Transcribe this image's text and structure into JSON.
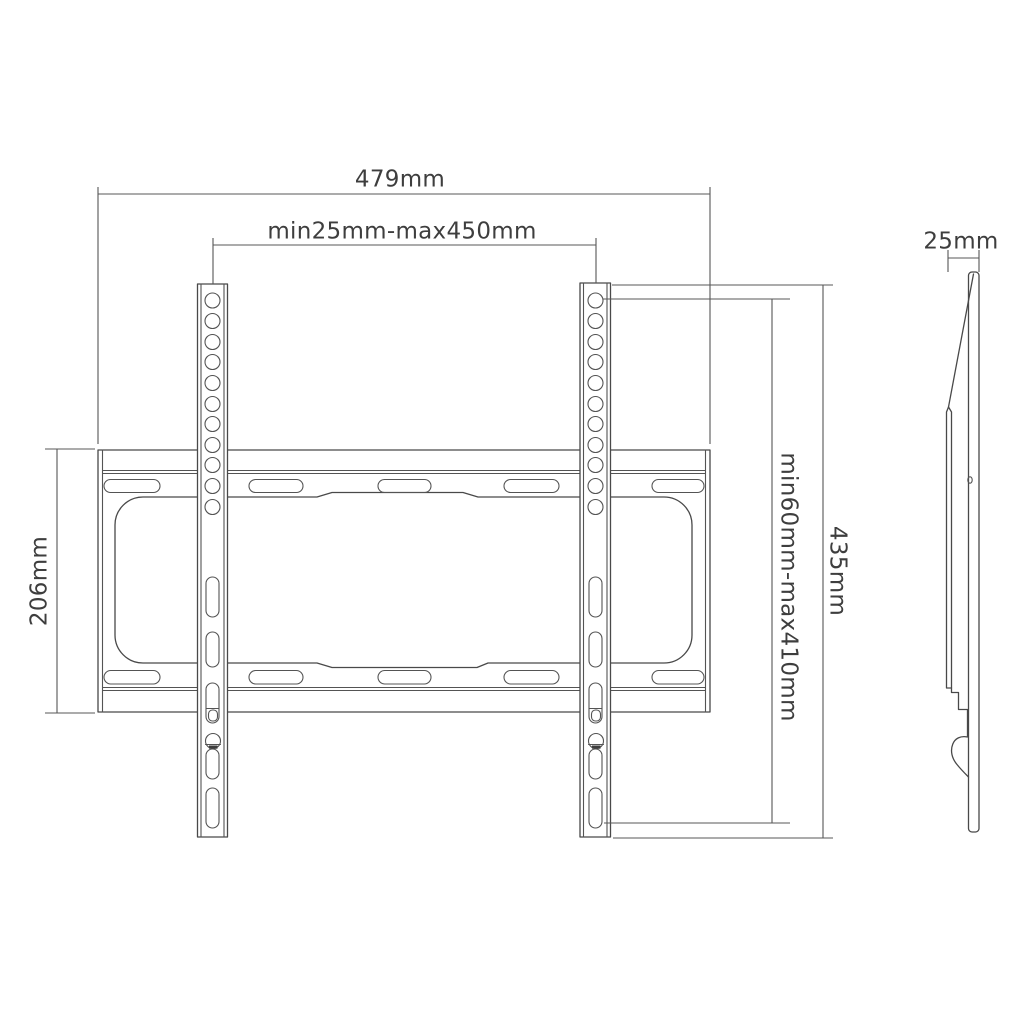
{
  "drawing": {
    "title": "TV wall mount bracket dimensional diagram",
    "views": {
      "front_view": "wall plate with two VESA rails",
      "side_view": "bracket profile"
    },
    "colors": {
      "background": "#ffffff",
      "line": "#494949",
      "dimension_line": "#575757",
      "text": "#3e3e3e"
    }
  },
  "labels": {
    "width": "479mm",
    "vesa_horizontal_range": "min25mm-max450mm",
    "plate_height": "206mm",
    "bracket_height": "435mm",
    "vesa_vertical_range": "min60mm-max410mm",
    "depth": "25mm"
  }
}
